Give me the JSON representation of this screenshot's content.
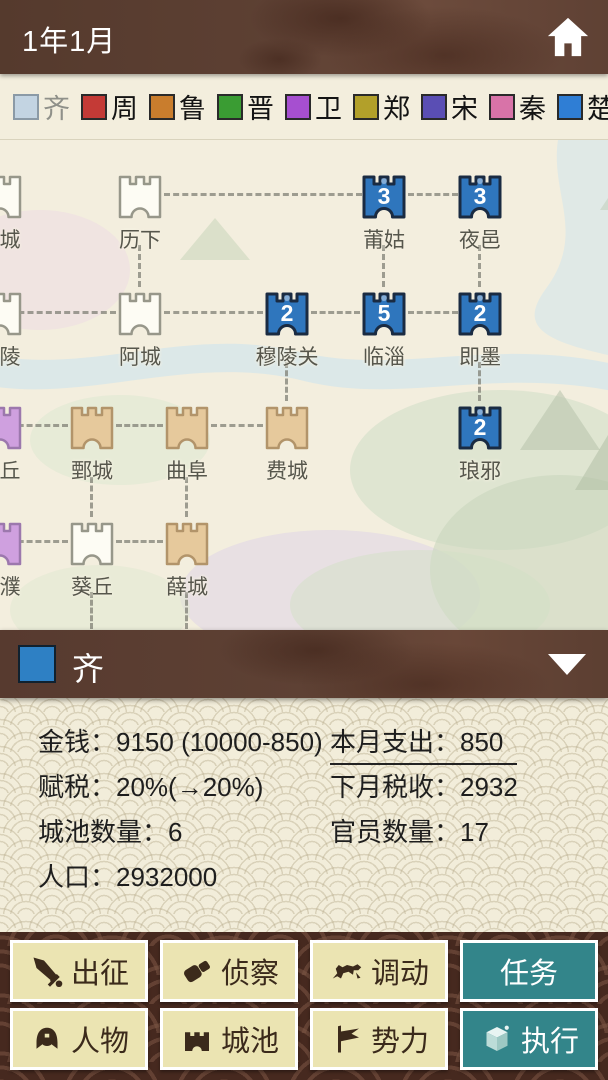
{
  "top_bar": {
    "title": "1年1月"
  },
  "legend": {
    "states": [
      {
        "name": "齐",
        "color": "#c3d4e2",
        "border": "#8b9aa6",
        "text_color": "#8f9089"
      },
      {
        "name": "周",
        "color": "#c43a36",
        "border": "#2a2a2a",
        "text_color": "#141414"
      },
      {
        "name": "鲁",
        "color": "#c97d2d",
        "border": "#2a2a2a",
        "text_color": "#141414"
      },
      {
        "name": "晋",
        "color": "#3a9c33",
        "border": "#2a2a2a",
        "text_color": "#141414"
      },
      {
        "name": "卫",
        "color": "#a64fd0",
        "border": "#2a2a2a",
        "text_color": "#141414"
      },
      {
        "name": "郑",
        "color": "#b2a02a",
        "border": "#2a2a2a",
        "text_color": "#141414"
      },
      {
        "name": "宋",
        "color": "#5a4eb4",
        "border": "#2a2a2a",
        "text_color": "#141414"
      },
      {
        "name": "秦",
        "color": "#d873a8",
        "border": "#2a2a2a",
        "text_color": "#141414"
      },
      {
        "name": "楚",
        "color": "#2f7ed5",
        "border": "#2a2a2a",
        "text_color": "#141414"
      },
      {
        "name": "吴",
        "color": "#8a5a33",
        "border": "#2a2a2a",
        "text_color": "#141414"
      }
    ]
  },
  "map": {
    "owners": {
      "neutral": {
        "fill": "#fdfcf4",
        "border": "#97978a"
      },
      "qi": {
        "fill": "#2f76bd",
        "border": "#1a2b42"
      },
      "lu": {
        "fill": "#e6c99c",
        "border": "#b2946a"
      },
      "wei": {
        "fill": "#cfa0df",
        "border": "#9c78ad"
      }
    },
    "cities": [
      {
        "name": "城",
        "x": 0,
        "y": 32,
        "owner": "neutral",
        "label_dx": 10
      },
      {
        "name": "历下",
        "x": 140,
        "y": 32,
        "owner": "neutral"
      },
      {
        "name": "莆姑",
        "x": 384,
        "y": 32,
        "owner": "qi",
        "troops": "3"
      },
      {
        "name": "夜邑",
        "x": 480,
        "y": 32,
        "owner": "qi",
        "troops": "3"
      },
      {
        "name": "陵",
        "x": 0,
        "y": 149,
        "owner": "neutral",
        "label_dx": 10
      },
      {
        "name": "阿城",
        "x": 140,
        "y": 149,
        "owner": "neutral"
      },
      {
        "name": "穆陵关",
        "x": 287,
        "y": 149,
        "owner": "qi",
        "troops": "2"
      },
      {
        "name": "临淄",
        "x": 384,
        "y": 149,
        "owner": "qi",
        "troops": "5"
      },
      {
        "name": "即墨",
        "x": 480,
        "y": 149,
        "owner": "qi",
        "troops": "2"
      },
      {
        "name": "丘",
        "x": 0,
        "y": 263,
        "owner": "wei",
        "label_dx": 10
      },
      {
        "name": "鄄城",
        "x": 92,
        "y": 263,
        "owner": "lu"
      },
      {
        "name": "曲阜",
        "x": 187,
        "y": 263,
        "owner": "lu"
      },
      {
        "name": "费城",
        "x": 287,
        "y": 263,
        "owner": "lu"
      },
      {
        "name": "琅邪",
        "x": 480,
        "y": 263,
        "owner": "qi",
        "troops": "2"
      },
      {
        "name": "濮",
        "x": 0,
        "y": 379,
        "owner": "wei",
        "label_dx": 10
      },
      {
        "name": "葵丘",
        "x": 92,
        "y": 379,
        "owner": "neutral"
      },
      {
        "name": "薛城",
        "x": 187,
        "y": 379,
        "owner": "lu"
      }
    ],
    "edges": [
      {
        "dir": "h",
        "x": 164,
        "y": 53,
        "len": 198
      },
      {
        "dir": "h",
        "x": 408,
        "y": 53,
        "len": 50
      },
      {
        "dir": "h",
        "x": 0,
        "y": 171,
        "len": 116
      },
      {
        "dir": "h",
        "x": 164,
        "y": 171,
        "len": 99
      },
      {
        "dir": "h",
        "x": 311,
        "y": 171,
        "len": 49
      },
      {
        "dir": "h",
        "x": 408,
        "y": 171,
        "len": 50
      },
      {
        "dir": "h",
        "x": 0,
        "y": 284,
        "len": 68
      },
      {
        "dir": "h",
        "x": 116,
        "y": 284,
        "len": 47
      },
      {
        "dir": "h",
        "x": 211,
        "y": 284,
        "len": 52
      },
      {
        "dir": "h",
        "x": 0,
        "y": 400,
        "len": 68
      },
      {
        "dir": "h",
        "x": 116,
        "y": 400,
        "len": 47
      },
      {
        "dir": "v",
        "x": 138,
        "y": 105,
        "len": 42
      },
      {
        "dir": "v",
        "x": 382,
        "y": 105,
        "len": 42
      },
      {
        "dir": "v",
        "x": 478,
        "y": 105,
        "len": 42
      },
      {
        "dir": "v",
        "x": 285,
        "y": 222,
        "len": 39
      },
      {
        "dir": "v",
        "x": 478,
        "y": 222,
        "len": 39
      },
      {
        "dir": "v",
        "x": 90,
        "y": 337,
        "len": 40
      },
      {
        "dir": "v",
        "x": 185,
        "y": 337,
        "len": 40
      },
      {
        "dir": "v",
        "x": 90,
        "y": 452,
        "len": 37
      },
      {
        "dir": "v",
        "x": 185,
        "y": 452,
        "len": 37
      }
    ]
  },
  "state_panel": {
    "selected_state": "齐",
    "selected_color": "#2e80c4",
    "stats_left": [
      {
        "text": "金钱：9150 (10000-850)"
      },
      {
        "text": "赋税：20%(→20%)"
      },
      {
        "text": "城池数量：6"
      },
      {
        "text": "人口：2932000"
      }
    ],
    "stats_right": [
      {
        "text": "本月支出：850",
        "underline": true
      },
      {
        "text": "下月税收：2932"
      },
      {
        "text": "官员数量：17"
      }
    ]
  },
  "actions": {
    "row1": [
      {
        "label": "出征",
        "icon": "sword-icon"
      },
      {
        "label": "侦察",
        "icon": "spyglass-icon"
      },
      {
        "label": "调动",
        "icon": "horse-icon"
      },
      {
        "label": "任务",
        "style": "teal"
      }
    ],
    "row2": [
      {
        "label": "人物",
        "icon": "helmet-icon"
      },
      {
        "label": "城池",
        "icon": "castle-icon"
      },
      {
        "label": "势力",
        "icon": "flag-icon"
      },
      {
        "label": "执行",
        "icon": "cube-icon",
        "style": "teal"
      }
    ]
  }
}
